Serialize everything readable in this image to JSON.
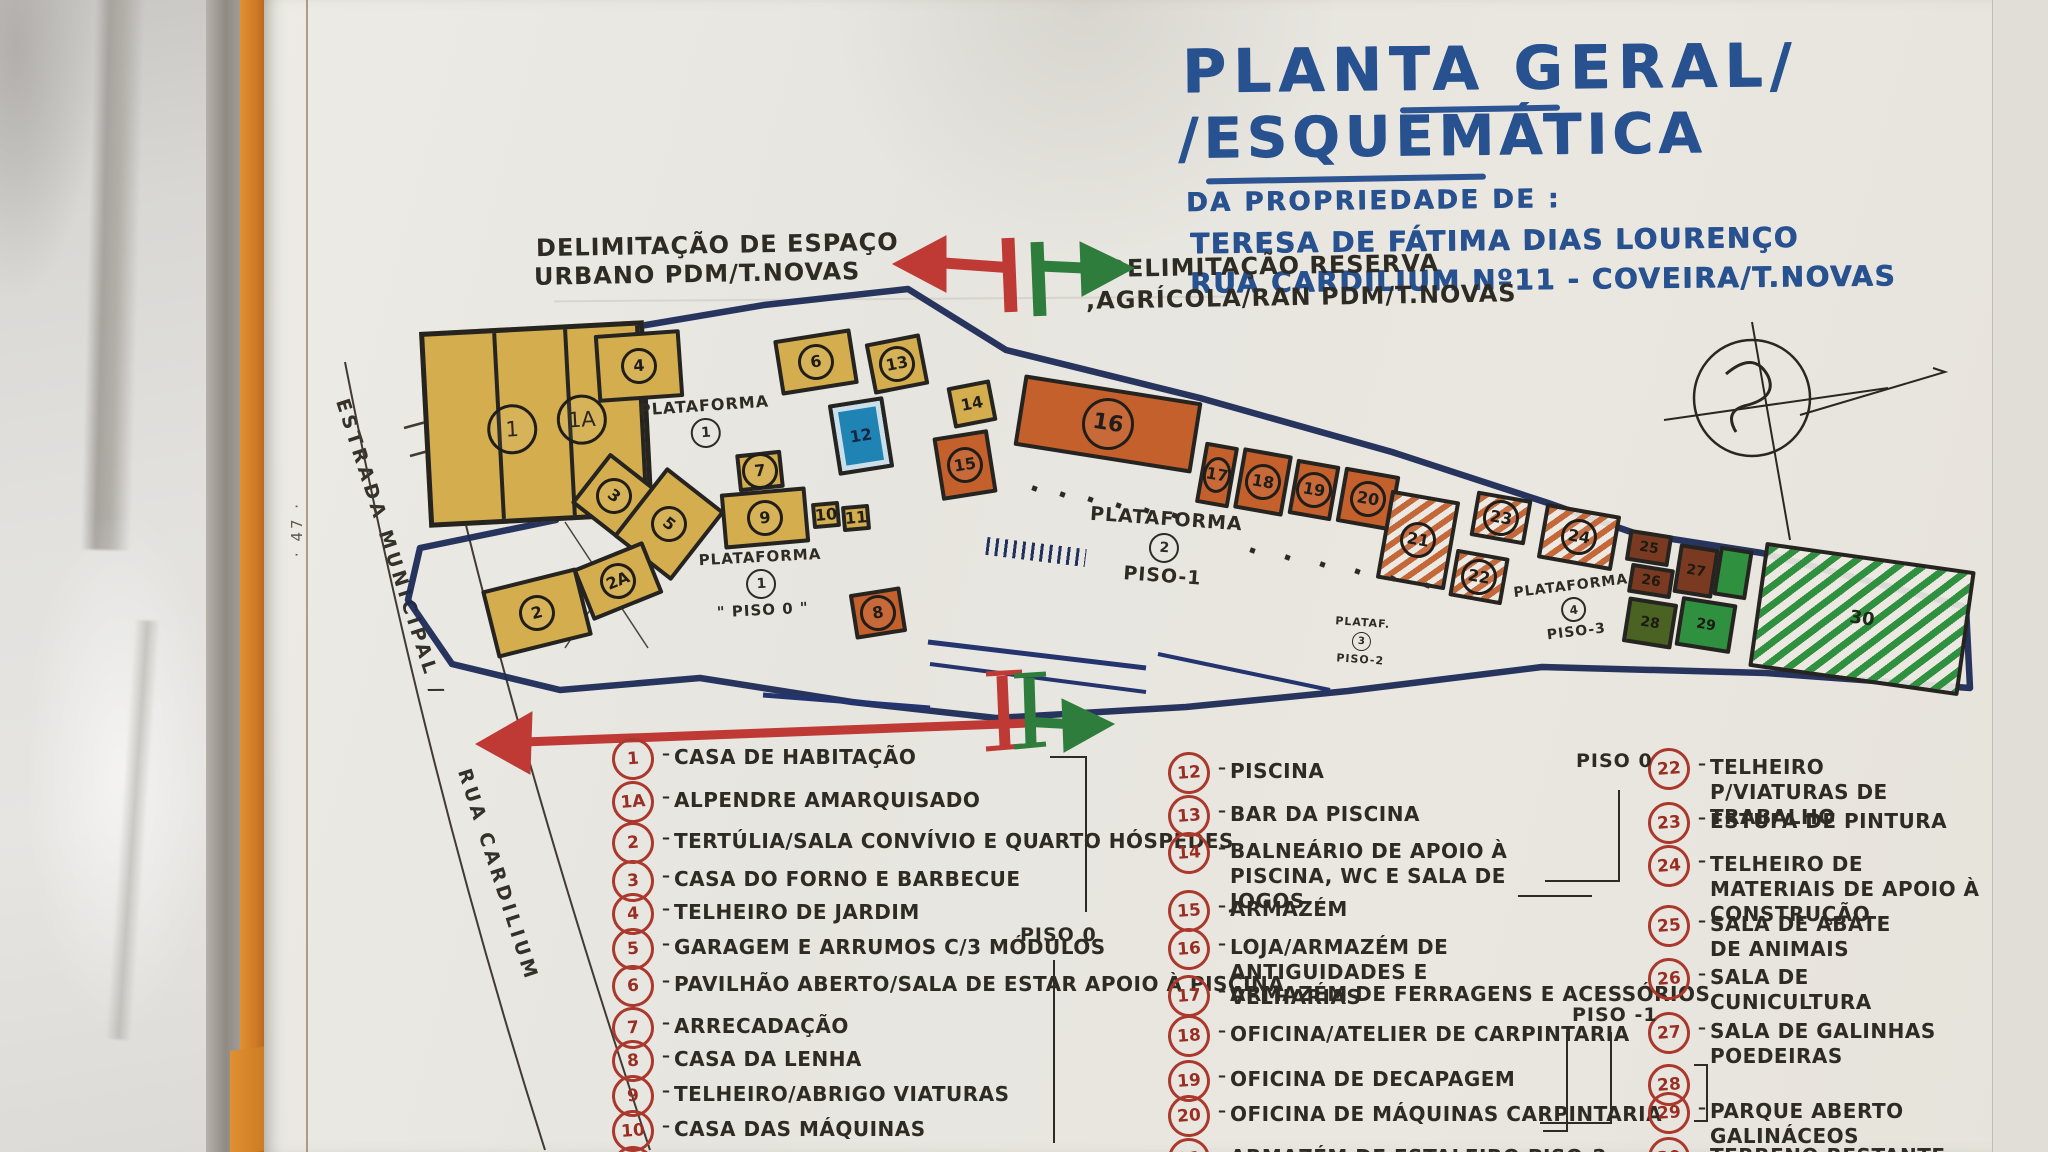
{
  "page": {
    "margin_note": "· 47 ·"
  },
  "title_block": {
    "line1": "PLANTA GERAL/",
    "line2": "/ESQUEMÁTICA",
    "owner_intro": "DA PROPRIEDADE DE :",
    "owner": "TERESA DE FÁTIMA DIAS LOURENÇO",
    "address": "RUA CARDILIUM Nº11 - COVEIRA/T.NOVAS"
  },
  "boundary_labels": {
    "urban_line1": "DELIMITAÇÃO DE ESPAÇO",
    "urban_line2": "URBANO PDM/T.NOVAS",
    "rural_line1": "DELIMITAÇÃO RESERVA",
    "rural_line2": ",AGRÍCOLA/RAN PDM/T.NOVAS"
  },
  "road": {
    "label_top": "ESTRADA MUNICIPAL /",
    "label_bottom": "RUA CARDILIUM"
  },
  "dash_glyph": "–",
  "building1": {
    "num": "1",
    "numA": "1A"
  },
  "buildings": [
    {
      "num": "4"
    },
    {
      "num": "6"
    },
    {
      "num": "13"
    },
    {
      "num": "12"
    },
    {
      "num": "3"
    },
    {
      "num": "5"
    },
    {
      "num": "7"
    },
    {
      "num": "9"
    },
    {
      "num": "10"
    },
    {
      "num": "11"
    },
    {
      "num": "2"
    },
    {
      "num": "2A"
    },
    {
      "num": "8"
    },
    {
      "num": "14"
    },
    {
      "num": "15"
    },
    {
      "num": "16"
    },
    {
      "num": "17"
    },
    {
      "num": "18"
    },
    {
      "num": "19"
    },
    {
      "num": "20"
    },
    {
      "num": "21"
    },
    {
      "num": "22"
    },
    {
      "num": "23"
    },
    {
      "num": "24"
    },
    {
      "num": "25"
    },
    {
      "num": "26"
    },
    {
      "num": "27"
    },
    {
      "num": "28"
    },
    {
      "num": "29"
    },
    {
      "num": ""
    },
    {
      "num": "30"
    }
  ],
  "platforms": [
    {
      "name": "PLATAFORMA",
      "num": "1",
      "piso": ""
    },
    {
      "name": "PLATAFORMA",
      "num": "1",
      "piso": "\" PISO 0 \""
    },
    {
      "name": "PLATAFORMA",
      "num": "2",
      "piso": "PISO-1"
    },
    {
      "name": "PLATAF.",
      "num": "3",
      "piso": "PISO-2"
    },
    {
      "name": "PLATAFORMA",
      "num": "4",
      "piso": "PISO-3"
    }
  ],
  "legend": {
    "piso0_mid": "PISO 0",
    "piso0_right": "PISO 0",
    "piso_minus1_right": "PISO -1",
    "columns": [
      {
        "items": [
          {
            "num": "1",
            "label": "CASA DE HABITAÇÃO"
          },
          {
            "num": "1A",
            "label": "ALPENDRE AMARQUISADO"
          },
          {
            "num": "2",
            "label": "TERTÚLIA/SALA CONVÍVIO E QUARTO HÓSPEDES"
          },
          {
            "num": "3",
            "label": "CASA DO FORNO E BARBECUE"
          },
          {
            "num": "4",
            "label": "TELHEIRO DE JARDIM"
          },
          {
            "num": "5",
            "label": "GARAGEM E ARRUMOS C/3 MÓDULOS"
          },
          {
            "num": "6",
            "label": "PAVILHÃO ABERTO/SALA DE ESTAR APOIO À PISCINA"
          },
          {
            "num": "7",
            "label": "ARRECADAÇÃO"
          },
          {
            "num": "8",
            "label": "CASA DA LENHA"
          },
          {
            "num": "9",
            "label": "TELHEIRO/ABRIGO VIATURAS"
          },
          {
            "num": "10",
            "label": "CASA DAS MÁQUINAS"
          },
          {
            "num": "11",
            "label": ""
          }
        ]
      },
      {
        "items": [
          {
            "num": "12",
            "label": "PISCINA"
          },
          {
            "num": "13",
            "label": "BAR DA PISCINA"
          },
          {
            "num": "14",
            "label": "BALNEÁRIO DE APOIO À PISCINA, WC E SALA DE JOGOS"
          },
          {
            "num": "15",
            "label": "ARMAZÉM"
          },
          {
            "num": "16",
            "label": "LOJA/ARMAZÉM DE ANTIGUIDADES E VELHARIAS"
          },
          {
            "num": "17",
            "label": "ARMAZÉM DE FERRAGENS E ACESSÓRIOS"
          },
          {
            "num": "18",
            "label": "OFICINA/ATELIER DE CARPINTARIA"
          },
          {
            "num": "19",
            "label": "OFICINA DE DECAPAGEM"
          },
          {
            "num": "20",
            "label": "OFICINA DE MÁQUINAS CARPINTARIA"
          },
          {
            "num": "21",
            "label": "ARMAZÉM DE ESTALEIRO PISO-2"
          }
        ]
      },
      {
        "items": [
          {
            "num": "22",
            "label": "TELHEIRO P/VIATURAS DE TRABALHO"
          },
          {
            "num": "23",
            "label": "ESTUFA DE PINTURA"
          },
          {
            "num": "24",
            "label": "TELHEIRO DE MATERIAIS DE APOIO À CONSTRUÇÃO"
          },
          {
            "num": "25",
            "label": "SALA DE ABATE DE ANIMAIS"
          },
          {
            "num": "26",
            "label": "SALA DE CUNICULTURA"
          },
          {
            "num": "27",
            "label": "SALA DE GALINHAS POEDEIRAS"
          },
          {
            "num": "28",
            "label": ""
          },
          {
            "num": "29",
            "label": "PARQUE ABERTO GALINÁCEOS"
          },
          {
            "num": "30",
            "label": "TERRENO RESTANTE"
          }
        ]
      }
    ]
  }
}
